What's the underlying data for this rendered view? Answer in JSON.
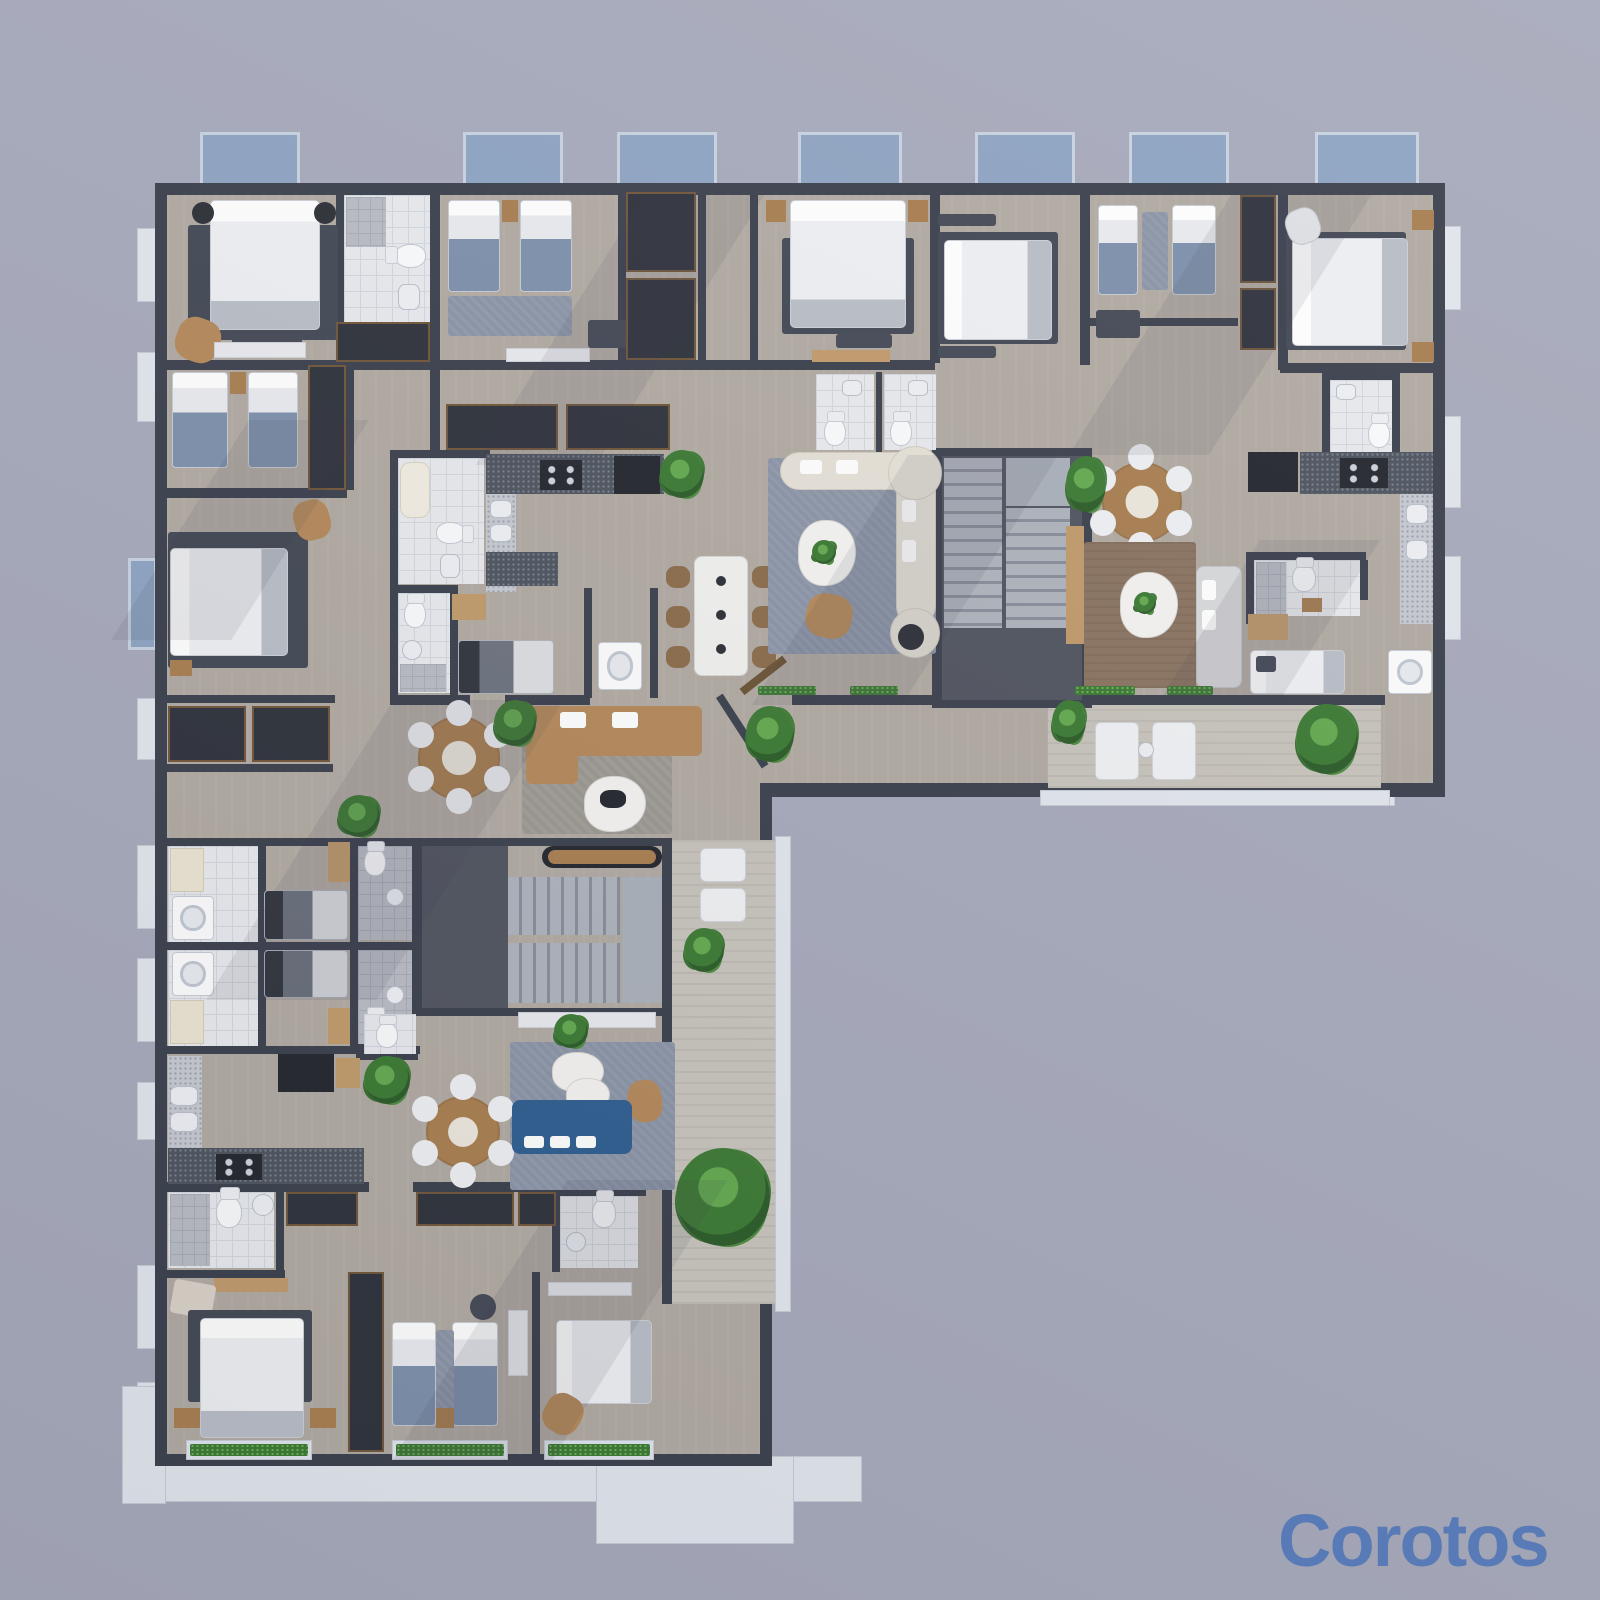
{
  "meta": {
    "type": "3d-rendered-floor-plan",
    "view": "top-down",
    "subject": "L-shaped multi-apartment residential floor plan rendering"
  },
  "watermark": {
    "text": "Corotos",
    "color": "#587ab6"
  },
  "palette": {
    "background": "#a7aabb",
    "wall": "#3b404d",
    "floor": "#b1aaa2",
    "floor_hall": "#a49e98",
    "tile": "#e8eaee",
    "tile_grout": "#d3d7de",
    "dark_hall": "#50545f",
    "stair_tread": "#aeb3bc",
    "stair_riser": "#878d99",
    "balcony_blue": "#8ea4c2",
    "balcony_frame": "#c9d3e1",
    "terrace_white": "#e2e6ed",
    "deck_wood": "#c8c4bc",
    "rug_dark": "#424854",
    "rug_blue": "#8a94a6",
    "rug_brown": "#8a7360",
    "bed_white": "#eef0f3",
    "sofa_cream": "#e6e1d7",
    "sofa_tan": "#b5895a",
    "sofa_blue": "#2f5e90",
    "sofa_gray": "#d8d9db",
    "wood": "#a97e50",
    "wood_light": "#c19a6b",
    "counter_dark": "#4e545e",
    "counter_light": "#c7cad1",
    "appliance_black": "#23262d",
    "plant_green": "#3c7a33",
    "fixture_white": "#fafbfc"
  },
  "scene": {
    "top_balconies": 7,
    "stairwells": 2,
    "rooms": [
      "bedroom",
      "kids-bedroom",
      "bathroom",
      "kitchen",
      "living-room",
      "dining-area",
      "laundry",
      "closet",
      "hallway",
      "stairwell",
      "balcony",
      "terrace"
    ],
    "furniture": [
      "double-bed",
      "single-bed",
      "twin-beds",
      "curved-sectional-sofa",
      "modular-tan-sofa",
      "blue-sofa",
      "gray-sofa",
      "round-dining-table",
      "marble-dining-table",
      "coffee-table",
      "armchair",
      "chaise-lounge",
      "desk",
      "wardrobe",
      "nightstand",
      "toilet",
      "sink",
      "shower",
      "bathtub",
      "washing-machine",
      "stove",
      "refrigerator",
      "kitchen-island",
      "console-table",
      "potted-plant",
      "area-rug",
      "stairs"
    ]
  }
}
